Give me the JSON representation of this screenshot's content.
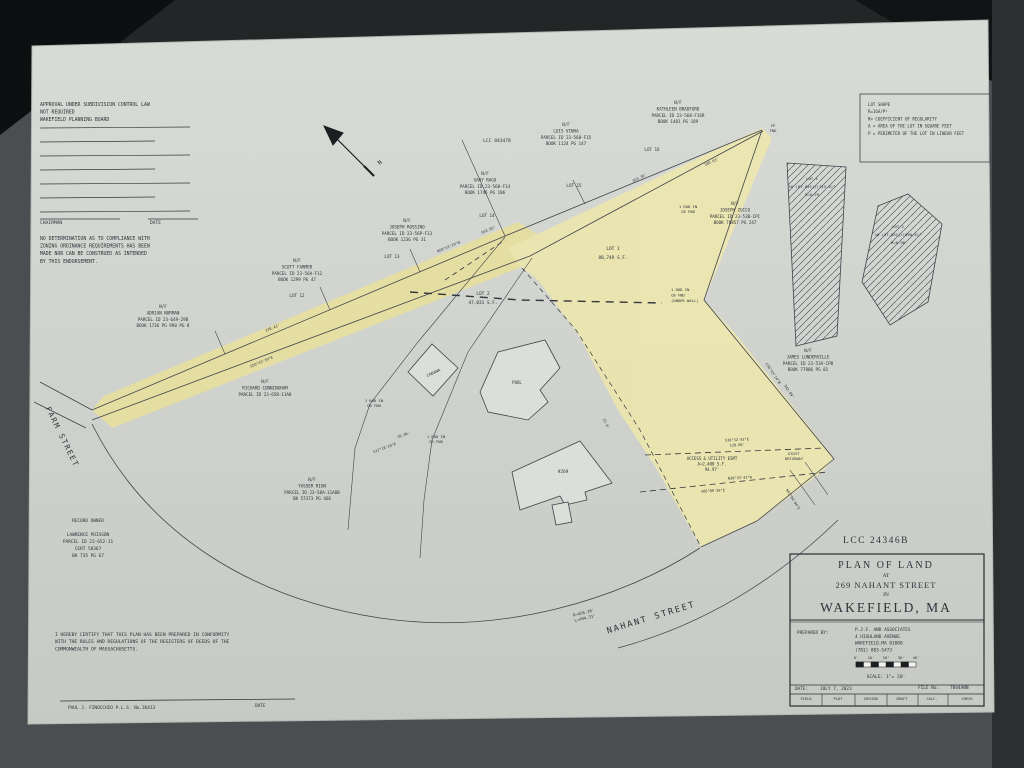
{
  "photo": {
    "background": "#4b4e51",
    "paper_color": "#d6d8d3",
    "highlight_color": "#e9e09b",
    "highlight_color_2": "#eee7ab",
    "ink": "#2f333a",
    "line": "#40444c"
  },
  "plan": {
    "labels": [
      {
        "name": "approval-block",
        "x": 40,
        "y": 106,
        "align": "start",
        "size": 4.8,
        "lh": 7.6,
        "lines": [
          "APPROVAL UNDER SUBDIVISION CONTROL LAW",
          "NOT REQUIRED",
          "WAKEFIELD PLANNING BOARD"
        ]
      },
      {
        "name": "chairman-label",
        "x": 40,
        "y": 224,
        "align": "start",
        "size": 4.6,
        "lines": [
          "CHAIRMAN"
        ]
      },
      {
        "name": "approval-date-label",
        "x": 150,
        "y": 224,
        "align": "start",
        "size": 4.6,
        "lines": [
          "DATE"
        ]
      },
      {
        "name": "zoning-note-block",
        "x": 40,
        "y": 240,
        "align": "start",
        "size": 4.8,
        "lh": 7.6,
        "lines": [
          "NO DETERMINATION AS TO COMPLIANCE WITH",
          "ZONING ORDINANCE REQUIREMENTS HAS BEEN",
          "MADE NOR CAN BE CONSTRUED AS INTENDED",
          "BY THIS ENDORSEMENT."
        ]
      },
      {
        "name": "lcc-plan-ref",
        "x": 497,
        "y": 142,
        "size": 4.6,
        "lines": [
          "LCC 843478"
        ]
      },
      {
        "name": "parcel-luis-vinha",
        "x": 566,
        "y": 126,
        "size": 4.2,
        "lh": 6.4,
        "lines": [
          "N/F",
          "LUIS VINHA",
          "PARCEL ID 23-568-F15",
          "BOOK 1124 PG 147"
        ]
      },
      {
        "name": "lot16-label",
        "x": 652,
        "y": 151,
        "size": 4.2,
        "lines": [
          "LOT 16"
        ]
      },
      {
        "name": "parcel-kathleen-bradford",
        "x": 678,
        "y": 104,
        "size": 4.2,
        "lh": 6.4,
        "lines": [
          "N/F",
          "KATHLEEN BRADFORD",
          "PARCEL ID 23-568-F16R",
          "BOOK 1481 PG 189"
        ]
      },
      {
        "name": "ip-fnd-tip",
        "x": 773,
        "y": 127,
        "size": 3.8,
        "lh": 5,
        "lines": [
          "IP",
          "FND"
        ]
      },
      {
        "name": "parcel-gary-rago",
        "x": 485,
        "y": 175,
        "size": 4.2,
        "lh": 6.4,
        "lines": [
          "N/F",
          "GARY RAGO",
          "PARCEL ID 23-568-F14",
          "BOOK 1746 PG 186"
        ]
      },
      {
        "name": "lot15-label",
        "x": 574,
        "y": 187,
        "size": 4.2,
        "lines": [
          "LOT 15"
        ]
      },
      {
        "name": "lot14-label",
        "x": 487,
        "y": 217,
        "size": 4.2,
        "lines": [
          "LOT 14"
        ]
      },
      {
        "name": "parcel-joseph-rossino",
        "x": 407,
        "y": 222,
        "size": 4.2,
        "lh": 6.4,
        "lines": [
          "N/F",
          "JOSEPH ROSSINO",
          "PARCEL ID 23-56P-F13",
          "BOOK 1236 PG 31"
        ]
      },
      {
        "name": "lot13-label",
        "x": 392,
        "y": 258,
        "size": 4.2,
        "lines": [
          "LOT 13"
        ]
      },
      {
        "name": "parcel-scott-farmer",
        "x": 297,
        "y": 262,
        "size": 4.2,
        "lh": 6.4,
        "lines": [
          "N/F",
          "SCOTT FARMER",
          "PARCEL ID 23-56A-F12",
          "BOOK 1299 PG 47"
        ]
      },
      {
        "name": "lot12-label",
        "x": 297,
        "y": 297,
        "size": 4.2,
        "lines": [
          "LOT 12"
        ]
      },
      {
        "name": "parcel-adrian-norman",
        "x": 163,
        "y": 308,
        "size": 4.2,
        "lh": 6.4,
        "lines": [
          "N/F",
          "ADRIAN NORMAN",
          "PARCEL ID 23-649-29B",
          "BOOK 1736 PG 990 PG 8"
        ]
      },
      {
        "name": "lot2-area-label",
        "x": 483,
        "y": 295,
        "size": 4.4,
        "lh": 9,
        "lines": [
          "LOT 2",
          "47,031 S.F."
        ]
      },
      {
        "name": "lot1-area-label",
        "x": 613,
        "y": 250,
        "size": 4.4,
        "lh": 9,
        "lines": [
          "LOT 1",
          "88,749 S.F."
        ]
      },
      {
        "name": "parcel-joseph-zucco",
        "x": 735,
        "y": 205,
        "size": 4.2,
        "lh": 6.4,
        "lines": [
          "N/F",
          "JOSEPH ZUCCO",
          "PARCEL ID 23-53B-CPC",
          "BOOK 76857 PG 247"
        ]
      },
      {
        "name": "rod-cb-fnd-1",
        "x": 688,
        "y": 208,
        "size": 3.8,
        "lh": 5,
        "lines": [
          "1 ROD IN",
          "CB FND"
        ]
      },
      {
        "name": "rod-cb-fnd-under-wall",
        "x": 671,
        "y": 291,
        "align": "start",
        "size": 3.8,
        "lh": 5.4,
        "lines": [
          "1 ROD IN",
          "CB FND",
          "(UNDER WALL)"
        ]
      },
      {
        "name": "parcel-james-lunderville",
        "x": 808,
        "y": 352,
        "size": 4.2,
        "lh": 6.4,
        "lines": [
          "N/F",
          "JAMES LUNDERVILLE",
          "PARCEL ID 23-53A-CPB",
          "BOOK 77806 PG 81"
        ]
      },
      {
        "name": "parcel-richard-cunningham",
        "x": 265,
        "y": 383,
        "size": 4.2,
        "lh": 6.4,
        "lines": [
          "N/F",
          "RICHARD CUNNINGHAM",
          "PARCEL ID 23-65B-11A8"
        ]
      },
      {
        "name": "cabana-label",
        "x": 434,
        "y": 374,
        "size": 4,
        "rotate": -24,
        "lines": [
          "CABANA"
        ]
      },
      {
        "name": "pool-label",
        "x": 517,
        "y": 384,
        "size": 4,
        "lines": [
          "POOL"
        ]
      },
      {
        "name": "rod-cb-fnd-2",
        "x": 374,
        "y": 402,
        "size": 3.8,
        "lh": 5,
        "lines": [
          "1 ROD IN",
          "CB FND"
        ]
      },
      {
        "name": "rod-cb-fnd-3",
        "x": 436,
        "y": 438,
        "size": 3.8,
        "lh": 5,
        "lines": [
          "1 ROD IN",
          "CB FND"
        ]
      },
      {
        "name": "parcel-yasser-rion",
        "x": 312,
        "y": 481,
        "size": 4.2,
        "lh": 6.4,
        "lines": [
          "N/F",
          "YASSER RION",
          "PARCEL ID 23-58A-11A8B",
          "BK 57373 PG 466"
        ]
      },
      {
        "name": "house-number-label",
        "x": 563,
        "y": 473,
        "size": 4.4,
        "lines": [
          "#269"
        ]
      },
      {
        "name": "easement-label",
        "x": 712,
        "y": 460,
        "size": 4,
        "lh": 5.6,
        "lines": [
          "ACCESS & UTILITY ESMT",
          "A=2,400 S.F.",
          "94.97'"
        ]
      },
      {
        "name": "exist-driveway-label",
        "x": 794,
        "y": 455,
        "size": 3.8,
        "lh": 5,
        "lines": [
          "EXIST",
          "DRIVEWAY"
        ]
      },
      {
        "name": "record-owner-block",
        "x": 88,
        "y": 522,
        "size": 4.4,
        "lh": 7,
        "lines": [
          "RECORD OWNER",
          "",
          "LAWRENCE POISSON",
          "PARCEL ID 23-652-11",
          "CERT 58367",
          "BK 735 PG 67"
        ]
      },
      {
        "name": "certification-block",
        "x": 55,
        "y": 636,
        "align": "start",
        "size": 4.6,
        "lh": 7.2,
        "lines": [
          "I HEREBY CERTIFY THAT THIS PLAN HAS BEEN PREPARED IN CONFORMITY",
          "WITH THE RULES AND REGULATIONS OF THE REGISTERS OF DEEDS OF THE",
          "COMMONWEALTH OF MASSACHUSETTS."
        ]
      },
      {
        "name": "surveyor-signature",
        "x": 68,
        "y": 709,
        "align": "start",
        "size": 4.4,
        "lines": [
          "PAUL J. FINOCCHIO P.L.S. No.36413"
        ]
      },
      {
        "name": "signature-date-label",
        "x": 255,
        "y": 707,
        "align": "start",
        "size": 4.4,
        "lines": [
          "DATE"
        ]
      },
      {
        "name": "farm-street-name",
        "x": 60,
        "y": 438,
        "size": 7.5,
        "rotate": 64,
        "spacing": 1.5,
        "lines": [
          "FARM  STREET"
        ]
      },
      {
        "name": "nahant-street-name",
        "x": 652,
        "y": 620,
        "size": 8.5,
        "rotate": -17,
        "spacing": 2,
        "lines": [
          "NAHANT  STREET"
        ]
      },
      {
        "name": "street-curve-dims",
        "x": 584,
        "y": 614,
        "size": 4,
        "lh": 5.6,
        "rotate": -14,
        "lines": [
          "R=456.36'",
          "L=494.31'"
        ]
      },
      {
        "name": "north-letter",
        "x": 381,
        "y": 164,
        "size": 6,
        "rotate": -40,
        "lines": [
          "N"
        ]
      },
      {
        "name": "lot-shape-legend",
        "x": 868,
        "y": 106,
        "align": "start",
        "size": 4.1,
        "lh": 7.2,
        "lines": [
          "LOT SHAPE",
          "R=16A/P²",
          "R= COEFFICIENT OF REGULARITY",
          "A = AREA OF THE LOT IN SQUARE FEET",
          "P = PERIMETER OF THE LOT IN LINEAR FEET"
        ]
      },
      {
        "name": "inset-lot1-label",
        "x": 812,
        "y": 180,
        "size": 3.9,
        "lh": 8,
        "lines": [
          "LOT 1",
          "16 (87,851)/(713.4)²",
          "R=0.79"
        ]
      },
      {
        "name": "inset-lot2-label",
        "x": 898,
        "y": 228,
        "size": 3.9,
        "lh": 8,
        "lines": [
          "LOT 2",
          "16 (47,031)/(890.5)²",
          "R=0.96"
        ]
      },
      {
        "name": "bearing-263",
        "x": 640,
        "y": 179,
        "size": 3.7,
        "rotate": -27,
        "lines": [
          "263.36'"
        ]
      },
      {
        "name": "bearing-189",
        "x": 712,
        "y": 163,
        "size": 3.7,
        "rotate": -25,
        "lines": [
          "189.63'"
        ]
      },
      {
        "name": "bearing-563",
        "x": 489,
        "y": 231,
        "size": 3.7,
        "rotate": -23,
        "lines": [
          "563.95'"
        ]
      },
      {
        "name": "bearing-n50",
        "x": 449,
        "y": 248,
        "size": 3.7,
        "rotate": -23,
        "lines": [
          "N50°43'20\"W"
        ]
      },
      {
        "name": "bearing-230",
        "x": 273,
        "y": 329,
        "size": 3.7,
        "rotate": -23,
        "lines": [
          "230.43'"
        ]
      },
      {
        "name": "bearing-s50",
        "x": 262,
        "y": 363,
        "size": 3.7,
        "rotate": -23,
        "lines": [
          "S50°43'20\"E"
        ]
      },
      {
        "name": "bearing-s36",
        "x": 772,
        "y": 374,
        "size": 3.7,
        "rotate": 56,
        "lines": [
          "S36°43'14\"W"
        ]
      },
      {
        "name": "bearing-342",
        "x": 788,
        "y": 392,
        "size": 3.7,
        "rotate": 56,
        "lines": [
          "342.99'"
        ]
      },
      {
        "name": "bearing-s38",
        "x": 737,
        "y": 441,
        "size": 3.6,
        "lh": 5.2,
        "rotate": -3,
        "lines": [
          "S38°32'43\"E",
          "129.66'"
        ]
      },
      {
        "name": "bearing-n38",
        "x": 740,
        "y": 479,
        "size": 3.6,
        "rotate": -3,
        "lines": [
          "N38°33'43\"W"
        ]
      },
      {
        "name": "bearing-s66",
        "x": 713,
        "y": 492,
        "size": 3.6,
        "rotate": -3,
        "lines": [
          "S66°09'28\"E"
        ]
      },
      {
        "name": "bearing-25-9",
        "x": 605,
        "y": 424,
        "size": 3.6,
        "rotate": 62,
        "lines": [
          "25.9'"
        ]
      },
      {
        "name": "bearing-s12",
        "x": 385,
        "y": 449,
        "size": 3.6,
        "rotate": -20,
        "lines": [
          "S12°18'20\"E"
        ]
      },
      {
        "name": "bearing-39",
        "x": 404,
        "y": 436,
        "size": 3.6,
        "rotate": -20,
        "lines": [
          "39.06'"
        ]
      },
      {
        "name": "bearing-n43",
        "x": 792,
        "y": 500,
        "size": 3.6,
        "rotate": 58,
        "lines": [
          "N43°04'04\"E"
        ]
      },
      {
        "name": "registry-number",
        "x": 876,
        "y": 543,
        "size": 9.5,
        "serif": true,
        "spacing": 1.5,
        "lines": [
          "LCC 24346B"
        ]
      },
      {
        "name": "title-plan-of-land",
        "x": 886,
        "y": 568,
        "size": 10,
        "serif": true,
        "spacing": 2,
        "lines": [
          "PLAN  OF  LAND"
        ]
      },
      {
        "name": "title-at",
        "x": 886,
        "y": 577,
        "size": 5.5,
        "serif": true,
        "lines": [
          "AT"
        ]
      },
      {
        "name": "title-address",
        "x": 886,
        "y": 588,
        "size": 8.5,
        "serif": true,
        "spacing": 1,
        "lines": [
          "269  NAHANT  STREET"
        ]
      },
      {
        "name": "title-in",
        "x": 886,
        "y": 596,
        "size": 5.5,
        "serif": true,
        "lines": [
          "IN"
        ]
      },
      {
        "name": "title-town",
        "x": 886,
        "y": 612,
        "size": 13.5,
        "serif": true,
        "spacing": 2,
        "lines": [
          "WAKEFIELD,  MA"
        ]
      },
      {
        "name": "tb-prepared-label",
        "x": 797,
        "y": 634,
        "align": "start",
        "size": 4.4,
        "lines": [
          "PREPARED BY:"
        ]
      },
      {
        "name": "tb-firm-block",
        "x": 855,
        "y": 631,
        "align": "start",
        "size": 4.4,
        "lh": 6.8,
        "lines": [
          "P.J.F. AND ASSOCIATES",
          "4 HIGHLAND AVENUE",
          "WAKEFIELD,MA 01880",
          "(781) 883-5473"
        ]
      },
      {
        "name": "tb-scale-tick-0",
        "x": 856,
        "y": 659,
        "size": 3.6,
        "lines": [
          "0'"
        ]
      },
      {
        "name": "tb-scale-tick-10",
        "x": 871,
        "y": 659,
        "size": 3.6,
        "lines": [
          "10'"
        ]
      },
      {
        "name": "tb-scale-tick-20",
        "x": 886,
        "y": 659,
        "size": 3.6,
        "lines": [
          "20'"
        ]
      },
      {
        "name": "tb-scale-tick-30",
        "x": 901,
        "y": 659,
        "size": 3.6,
        "lines": [
          "30'"
        ]
      },
      {
        "name": "tb-scale-tick-40",
        "x": 916,
        "y": 659,
        "size": 3.6,
        "lines": [
          "40'"
        ]
      },
      {
        "name": "tb-scale-text",
        "x": 886,
        "y": 678,
        "size": 4.6,
        "lines": [
          "SCALE: 1\"= 20'"
        ]
      },
      {
        "name": "tb-date-label",
        "x": 795,
        "y": 690,
        "align": "start",
        "size": 4.4,
        "lines": [
          "DATE:"
        ]
      },
      {
        "name": "tb-date-value",
        "x": 820,
        "y": 690,
        "align": "start",
        "size": 4.4,
        "lines": [
          "JULY 7, 2023"
        ]
      },
      {
        "name": "tb-file-label",
        "x": 918,
        "y": 689,
        "align": "start",
        "size": 4.4,
        "lines": [
          "FILE No."
        ]
      },
      {
        "name": "tb-file-value",
        "x": 950,
        "y": 689,
        "align": "start",
        "size": 4.4,
        "lines": [
          "7844ANN"
        ]
      },
      {
        "name": "tb-cell-field",
        "x": 806,
        "y": 700,
        "size": 3.7,
        "lines": [
          "FIELD"
        ]
      },
      {
        "name": "tb-cell-plot",
        "x": 838,
        "y": 700,
        "size": 3.7,
        "lines": [
          "PLOT"
        ]
      },
      {
        "name": "tb-cell-design",
        "x": 871,
        "y": 700,
        "size": 3.7,
        "lines": [
          "DESIGN"
        ]
      },
      {
        "name": "tb-cell-draft",
        "x": 902,
        "y": 700,
        "size": 3.7,
        "lines": [
          "DRAFT"
        ]
      },
      {
        "name": "tb-cell-calc",
        "x": 932,
        "y": 700,
        "size": 3.7,
        "lines": [
          "CALC."
        ]
      },
      {
        "name": "tb-cell-check",
        "x": 967,
        "y": 700,
        "size": 3.7,
        "lines": [
          "CHECK"
        ]
      }
    ]
  }
}
